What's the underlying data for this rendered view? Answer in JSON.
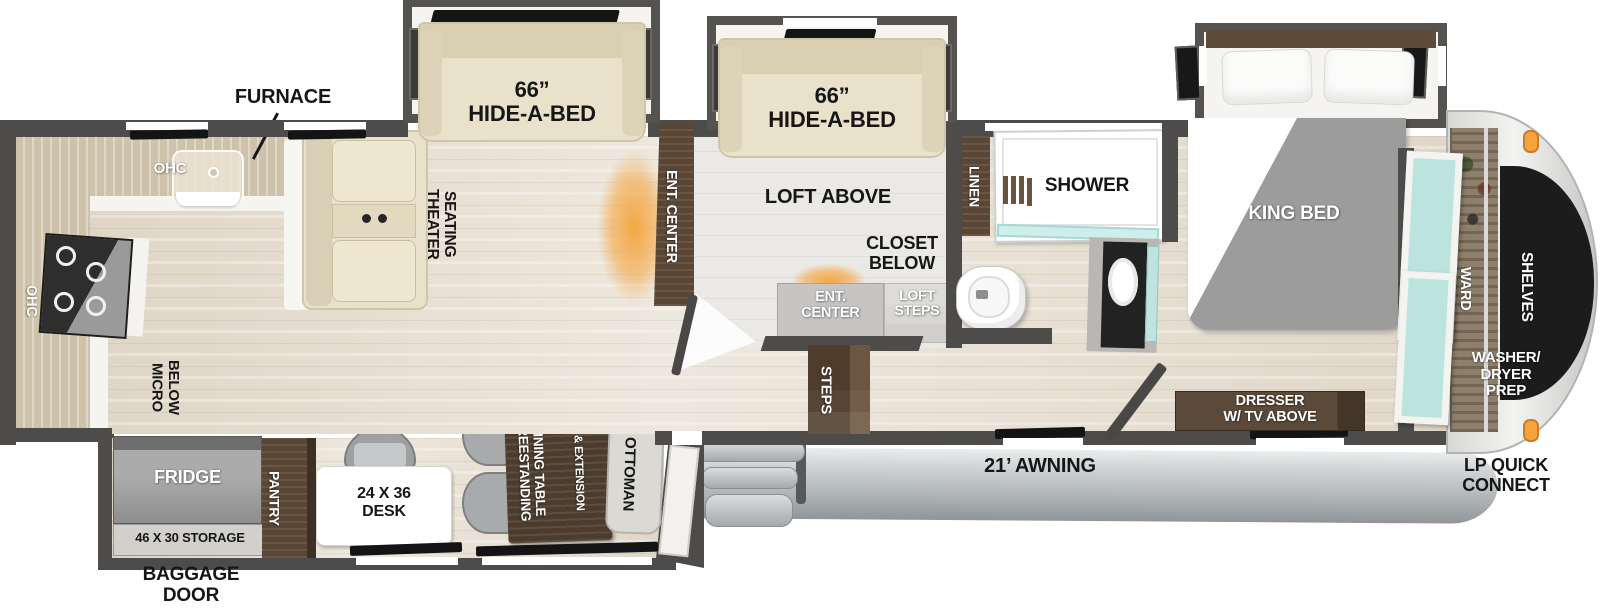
{
  "title": "Fifth wheel RV floor plan",
  "labels": {
    "furnace": "FURNACE",
    "ohc_top": "OHC",
    "ohc_side": "OHC",
    "micro_below": "MICRO\nBELOW",
    "hide_a_bed_left": "66”\nHIDE-A-BED",
    "hide_a_bed_right": "66”\nHIDE-A-BED",
    "theater_seating": "THEATER\nSEATING",
    "ent_center_strip": "ENT. CENTER",
    "loft_above": "LOFT ABOVE",
    "closet_below": "CLOSET\nBELOW",
    "ent_center_box": "ENT.\nCENTER",
    "loft_steps": "LOFT\nSTEPS",
    "steps": "STEPS",
    "linen": "LINEN",
    "shower": "SHOWER",
    "king_bed": "KING BED",
    "ward": "WARD",
    "shelves": "SHELVES",
    "washer_dryer_prep": "WASHER/\nDRYER\nPREP",
    "dresser": "DRESSER\nW/ TV ABOVE",
    "lp_quick_connect": "LP QUICK\nCONNECT",
    "awning": "21’ AWNING",
    "fridge": "FRIDGE",
    "storage": "46 X 30 STORAGE",
    "pantry": "PANTRY",
    "baggage_door": "BAGGAGE\nDOOR",
    "desk": "24 X 36\nDESK",
    "dining_table": "FREESTANDING\nDINING TABLE",
    "dining_ext": "& EXTENSION",
    "ottoman": "OTTOMAN"
  },
  "colors": {
    "wall": "#4e4c4a",
    "floor_wood": "#e8e1d4",
    "floor_loft": "#eae9e6",
    "cabinet_brown": "#5a4634",
    "counter_tan": "#cfc2ab",
    "teal_glass": "#bce4df",
    "glow_orange": "#f5a33b",
    "awning_gray": "#c6cacc",
    "sofa_beige": "#e9e1c9",
    "front_cap_black": "#1c1c1c"
  }
}
